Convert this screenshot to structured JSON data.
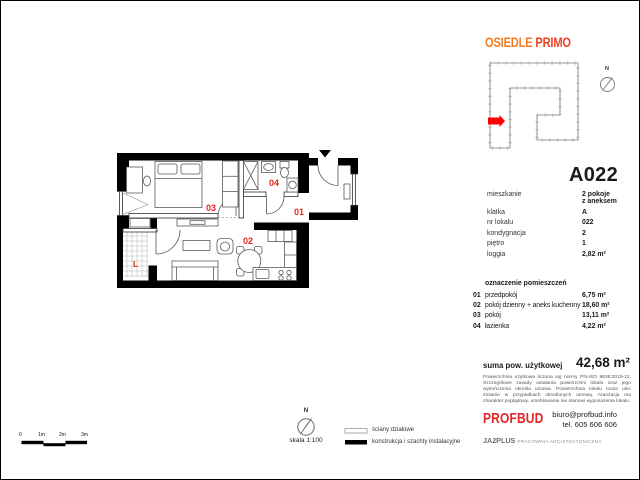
{
  "header": {
    "project_name_1": "OSIEDLE",
    "project_name_2": "PRIMO",
    "unit_code": "A022"
  },
  "site": {
    "north_label": "N"
  },
  "details": {
    "rows": [
      {
        "label": "mieszkanie",
        "value": "2 pokoje\nz aneksem"
      },
      {
        "label": "klatka",
        "value": "A"
      },
      {
        "label": "nr lokalu",
        "value": "022"
      },
      {
        "label": "kondygnacja",
        "value": "2"
      },
      {
        "label": "piętro",
        "value": "1"
      },
      {
        "label": "loggia",
        "value": "2,82 m²"
      }
    ]
  },
  "rooms": {
    "heading": "oznaczenie pomieszczeń",
    "items": [
      {
        "no": "01",
        "name": "przedpokój",
        "area": "6,75 m²"
      },
      {
        "no": "02",
        "name": "pokój dzienny + aneks kuchenny",
        "area": "18,60 m²"
      },
      {
        "no": "03",
        "name": "pokój",
        "area": "13,11 m²"
      },
      {
        "no": "04",
        "name": "łazienka",
        "area": "4,22 m²"
      }
    ]
  },
  "summary": {
    "label": "suma pow. użytkowej",
    "value": "42,68 m²",
    "disclaimer": "Powierzchnia użytkowa liczona wg normy PN-ISO 9836:2015-12. Szczegółowe zasady ustalania powierzchni lokalu oraz jego wykończenia określa umowa. Powierzchnia lokalu może ulec zmianie w przypadkach określonych umową. Aranżacja ma charakter poglądowy, umeblowanie nie stanowi wyposażenia lokalu."
  },
  "footer": {
    "brand": "PROFBUD",
    "email": "biuro@profbud.info",
    "phone": "tel. 605 606 606",
    "studio": "JA2PLUS",
    "studio_desc": "PRACOWNIA ARCHITEKTONICZNA"
  },
  "plan_labels": {
    "hall": "01",
    "living": "02",
    "room": "03",
    "bath": "04",
    "loggia": "L"
  },
  "scalebar": {
    "ticks": [
      "0",
      "1m",
      "2m",
      "3m"
    ],
    "scale_label": "skala 1:100",
    "north_label": "N"
  },
  "legend": {
    "partition": "ściany działowe",
    "structure": "konstrukcja i szachty instalacyjne"
  },
  "colors": {
    "accent_red": "#E8251D",
    "brand_red": "#E3262A",
    "orange": "#F47C20",
    "orange_red": "#EF4123",
    "wall_black": "#000000",
    "unit_marker": "#FF0000"
  }
}
